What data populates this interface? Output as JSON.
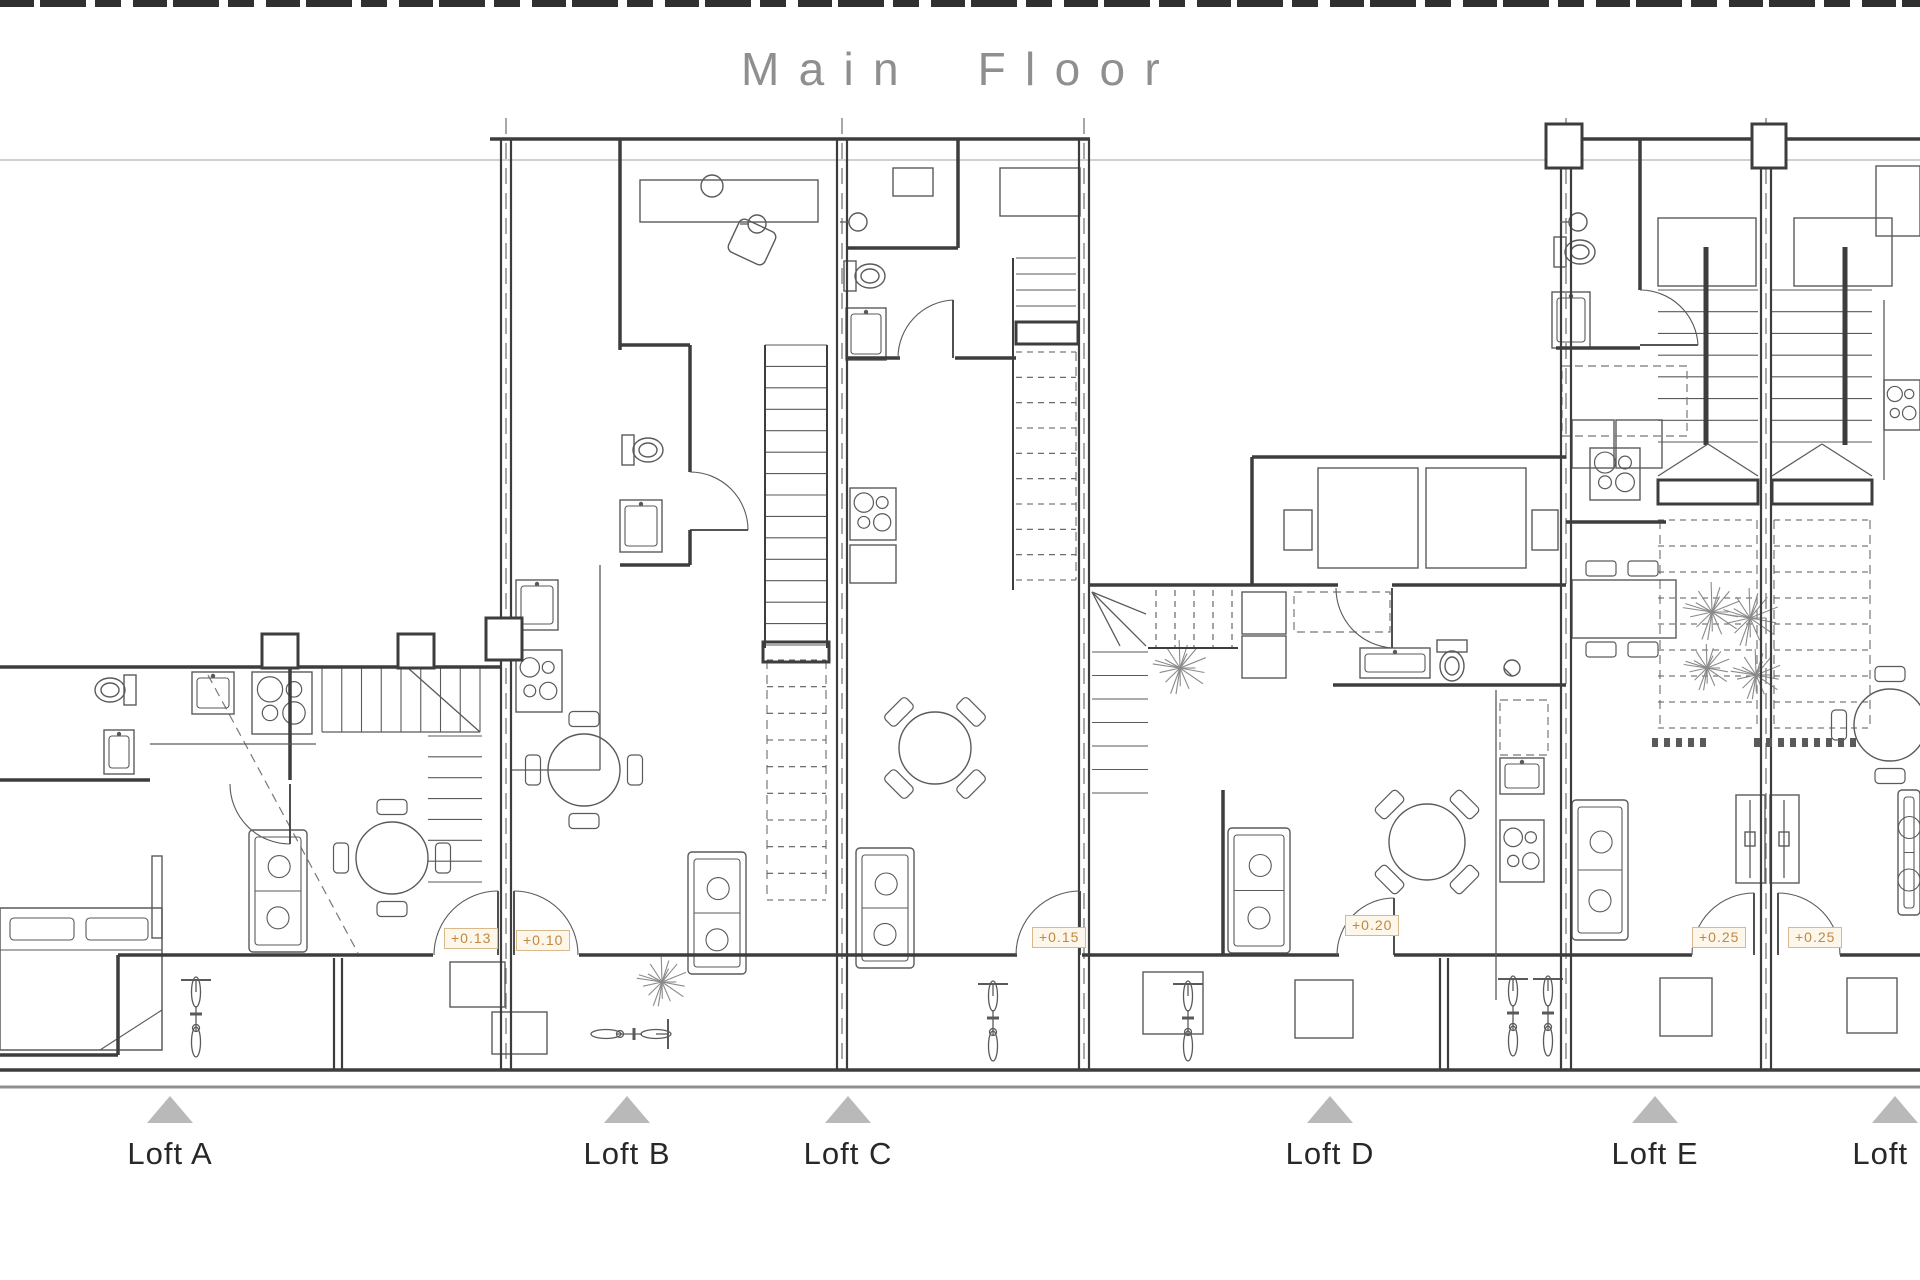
{
  "title": "Main Floor",
  "colors": {
    "wall": "#3d3d3d",
    "furniture": "#5a5a5a",
    "dashed": "#787878",
    "light": "#b5b5b5",
    "ground": "#8f8f8f",
    "plant": "#8a8a8a",
    "triangle": "#b9b9b9",
    "marker_text": "#c08840",
    "marker_border": "#d8b98c",
    "marker_bg": "#fdf6ea",
    "title": "#8f8f8f",
    "label": "#282828"
  },
  "elevation_markers": [
    {
      "label": "+0.13",
      "x": 444,
      "y": 928
    },
    {
      "label": "+0.10",
      "x": 516,
      "y": 930
    },
    {
      "label": "+0.15",
      "x": 1032,
      "y": 927
    },
    {
      "label": "+0.20",
      "x": 1345,
      "y": 915
    },
    {
      "label": "+0.25",
      "x": 1692,
      "y": 927
    },
    {
      "label": "+0.25",
      "x": 1788,
      "y": 927
    }
  ],
  "lofts": [
    {
      "label": "Loft A",
      "x": 170
    },
    {
      "label": "Loft B",
      "x": 627
    },
    {
      "label": "Loft C",
      "x": 848
    },
    {
      "label": "Loft D",
      "x": 1330
    },
    {
      "label": "Loft E",
      "x": 1655
    },
    {
      "label": "Loft F",
      "x": 1895
    }
  ],
  "plan": {
    "ref_line": [
      0,
      160,
      1920,
      160
    ],
    "ground_line": [
      0,
      1087,
      1920,
      1087
    ],
    "walls": [
      [
        490,
        139,
        1090,
        139
      ],
      [
        1548,
        139,
        1920,
        139
      ],
      [
        0,
        667,
        500,
        667
      ],
      [
        1090,
        585,
        1338,
        585
      ],
      [
        1392,
        585,
        1566,
        585
      ],
      [
        1252,
        457,
        1566,
        457
      ],
      [
        1252,
        457,
        1252,
        585
      ],
      [
        118,
        955,
        433,
        955
      ],
      [
        579,
        955,
        1017,
        955
      ],
      [
        1082,
        955,
        1339,
        955
      ],
      [
        1394,
        955,
        1692,
        955
      ],
      [
        1840,
        955,
        1920,
        955
      ],
      [
        0,
        1055,
        118,
        1055
      ],
      [
        118,
        955,
        118,
        1055
      ],
      [
        290,
        667,
        290,
        780
      ],
      [
        0,
        780,
        150,
        780
      ],
      [
        620,
        139,
        620,
        350
      ],
      [
        620,
        345,
        690,
        345
      ],
      [
        690,
        345,
        690,
        472
      ],
      [
        690,
        530,
        690,
        565
      ],
      [
        620,
        565,
        690,
        565
      ],
      [
        958,
        139,
        958,
        248
      ],
      [
        848,
        248,
        958,
        248
      ],
      [
        848,
        358,
        900,
        358
      ],
      [
        955,
        358,
        1016,
        358
      ],
      [
        1333,
        685,
        1566,
        685
      ],
      [
        1223,
        790,
        1223,
        955
      ],
      [
        1640,
        139,
        1640,
        290
      ],
      [
        1556,
        348,
        1640,
        348
      ],
      [
        1566,
        522,
        1666,
        522
      ],
      [
        0,
        1070,
        1920,
        1070
      ]
    ],
    "walls2": [
      [
        501,
        139,
        501,
        1070
      ],
      [
        511,
        139,
        511,
        1070
      ],
      [
        837,
        139,
        837,
        1070
      ],
      [
        847,
        139,
        847,
        1070
      ],
      [
        1079,
        139,
        1079,
        1070
      ],
      [
        1089,
        139,
        1089,
        1070
      ],
      [
        1561,
        139,
        1561,
        1070
      ],
      [
        1571,
        139,
        1571,
        1070
      ],
      [
        1761,
        139,
        1761,
        1070
      ],
      [
        1771,
        139,
        1771,
        1070
      ],
      [
        334,
        958,
        334,
        1070
      ],
      [
        342,
        958,
        342,
        1070
      ],
      [
        1440,
        958,
        1440,
        1070
      ],
      [
        1448,
        958,
        1448,
        1070
      ]
    ],
    "rails": [
      [
        765,
        345,
        765,
        648
      ],
      [
        827,
        345,
        827,
        648
      ],
      [
        1013,
        258,
        1013,
        590
      ],
      [
        1148,
        648,
        1238,
        648
      ]
    ],
    "bold": [
      [
        1706,
        247,
        1706,
        445
      ],
      [
        1845,
        247,
        1845,
        445
      ]
    ],
    "thin": [
      [
        150,
        744,
        316,
        744
      ],
      [
        600,
        565,
        600,
        770
      ],
      [
        512,
        770,
        600,
        770
      ],
      [
        1496,
        690,
        1496,
        1000
      ],
      [
        1884,
        300,
        1884,
        480
      ],
      [
        1750,
        800,
        1750,
        878
      ],
      [
        1784,
        800,
        1784,
        878
      ],
      [
        322,
        732,
        480,
        732
      ],
      [
        1658,
        476,
        1708,
        444
      ],
      [
        1708,
        444,
        1758,
        476
      ],
      [
        1772,
        476,
        1822,
        444
      ],
      [
        1822,
        444,
        1872,
        476
      ],
      [
        408,
        668,
        480,
        732
      ],
      [
        1092,
        592,
        1146,
        646
      ],
      [
        1092,
        592,
        1146,
        614
      ],
      [
        1092,
        592,
        1120,
        646
      ],
      [
        740,
        224,
        749,
        224
      ],
      [
        840,
        222,
        849,
        222
      ],
      [
        1560,
        222,
        1569,
        222
      ],
      [
        1504,
        668,
        1512,
        676
      ]
    ],
    "dash_heavy": [
      [
        506,
        118,
        506,
        1070
      ],
      [
        842,
        118,
        842,
        1070
      ],
      [
        1084,
        118,
        1084,
        1070
      ],
      [
        1566,
        118,
        1566,
        1070
      ],
      [
        1766,
        118,
        1766,
        1070
      ]
    ],
    "dash": [
      [
        208,
        675,
        358,
        953
      ],
      [
        767,
        660,
        767,
        900
      ],
      [
        826,
        660,
        826,
        900
      ],
      [
        1076,
        352,
        1076,
        580
      ],
      [
        1660,
        520,
        1660,
        728
      ],
      [
        1757,
        520,
        1757,
        728
      ],
      [
        1774,
        520,
        1774,
        728
      ],
      [
        1870,
        520,
        1870,
        728
      ]
    ],
    "treads": [
      [
        322,
        668,
        158,
        64,
        8,
        0,
        0
      ],
      [
        428,
        736,
        54,
        146,
        7,
        1,
        0
      ],
      [
        765,
        345,
        62,
        300,
        14,
        1,
        0
      ],
      [
        767,
        660,
        59,
        240,
        9,
        1,
        1
      ],
      [
        1016,
        258,
        60,
        64,
        4,
        1,
        0
      ],
      [
        1016,
        352,
        60,
        228,
        9,
        1,
        1
      ],
      [
        1156,
        590,
        76,
        58,
        4,
        0,
        1
      ],
      [
        1092,
        652,
        56,
        141,
        6,
        1,
        0
      ],
      [
        1658,
        290,
        100,
        152,
        7,
        1,
        0
      ],
      [
        1658,
        520,
        99,
        208,
        8,
        1,
        1
      ],
      [
        1772,
        290,
        100,
        152,
        7,
        1,
        0
      ],
      [
        1774,
        520,
        96,
        208,
        8,
        1,
        1
      ]
    ],
    "rects": [
      [
        152,
        856,
        10,
        82
      ],
      [
        450,
        962,
        55,
        45
      ],
      [
        492,
        1012,
        55,
        42
      ],
      [
        640,
        180,
        178,
        42
      ],
      [
        893,
        168,
        40,
        28
      ],
      [
        1000,
        168,
        80,
        48
      ],
      [
        850,
        545,
        46,
        38
      ],
      [
        1295,
        980,
        58,
        58
      ],
      [
        1143,
        972,
        60,
        62
      ],
      [
        1284,
        510,
        28,
        40
      ],
      [
        1532,
        510,
        26,
        40
      ],
      [
        1318,
        468,
        100,
        100
      ],
      [
        1426,
        468,
        100,
        100
      ],
      [
        1658,
        218,
        98,
        68
      ],
      [
        1794,
        218,
        98,
        68
      ],
      [
        1572,
        420,
        42,
        48
      ],
      [
        1616,
        420,
        46,
        48
      ],
      [
        1660,
        978,
        52,
        58
      ],
      [
        1736,
        795,
        29,
        88
      ],
      [
        1770,
        795,
        29,
        88
      ],
      [
        1745,
        832,
        10,
        14
      ],
      [
        1779,
        832,
        10,
        14
      ],
      [
        1876,
        166,
        44,
        70
      ],
      [
        1847,
        978,
        50,
        55
      ],
      [
        1242,
        592,
        44,
        42
      ],
      [
        1242,
        636,
        44,
        42
      ]
    ],
    "bold_rects": [
      [
        763,
        642,
        66,
        20
      ],
      [
        1016,
        322,
        62,
        22
      ],
      [
        1658,
        480,
        100,
        24
      ],
      [
        1772,
        480,
        100,
        24
      ]
    ],
    "dash_rects": [
      [
        1294,
        592,
        96,
        40
      ],
      [
        1500,
        700,
        48,
        55
      ],
      [
        1562,
        366,
        125,
        70
      ]
    ],
    "doors": [
      [
        290,
        784,
        290,
        844,
        230,
        784,
        1
      ],
      [
        690,
        530,
        748,
        530,
        690,
        472,
        0
      ],
      [
        953,
        358,
        953,
        300,
        898,
        358,
        0
      ],
      [
        1392,
        588,
        1392,
        648,
        1336,
        588,
        1
      ],
      [
        1640,
        345,
        1698,
        345,
        1640,
        290,
        0
      ],
      [
        498,
        955,
        498,
        891,
        434,
        955,
        0
      ],
      [
        514,
        955,
        514,
        891,
        578,
        955,
        1
      ],
      [
        1080,
        955,
        1080,
        891,
        1016,
        955,
        0
      ],
      [
        1394,
        955,
        1394,
        898,
        1337,
        955,
        0
      ],
      [
        1754,
        955,
        1754,
        893,
        1692,
        955,
        0
      ],
      [
        1778,
        955,
        1778,
        893,
        1840,
        955,
        1
      ]
    ],
    "circles": [
      [
        757,
        224,
        9
      ],
      [
        858,
        222,
        9
      ],
      [
        1578,
        222,
        9
      ],
      [
        1512,
        668,
        8
      ],
      [
        712,
        186,
        11
      ]
    ],
    "toilets": [
      [
        132,
        690,
        180
      ],
      [
        626,
        450,
        0
      ],
      [
        848,
        276,
        0
      ],
      [
        1452,
        644,
        90
      ],
      [
        1558,
        252,
        0
      ]
    ],
    "sinks": [
      [
        104,
        730,
        30,
        44
      ],
      [
        192,
        672,
        42,
        42
      ],
      [
        620,
        500,
        42,
        52
      ],
      [
        516,
        580,
        42,
        50
      ],
      [
        846,
        308,
        40,
        52
      ],
      [
        1500,
        758,
        44,
        36
      ],
      [
        1552,
        292,
        38,
        56
      ],
      [
        1360,
        648,
        70,
        30
      ]
    ],
    "stoves": [
      [
        252,
        672,
        60,
        62
      ],
      [
        516,
        650,
        46,
        62
      ],
      [
        850,
        488,
        46,
        52
      ],
      [
        1500,
        820,
        44,
        62
      ],
      [
        1590,
        448,
        50,
        52
      ],
      [
        1884,
        380,
        36,
        50
      ]
    ],
    "tables_round": [
      [
        392,
        858,
        36,
        0
      ],
      [
        584,
        770,
        36,
        0
      ],
      [
        935,
        748,
        36,
        45
      ],
      [
        1427,
        842,
        38,
        45
      ],
      [
        1890,
        725,
        36,
        0
      ]
    ],
    "tables_rect": [
      [
        1572,
        580,
        104,
        58
      ]
    ],
    "sofas": [
      [
        249,
        830,
        58,
        122
      ],
      [
        688,
        852,
        58,
        122
      ],
      [
        856,
        848,
        58,
        120
      ],
      [
        1228,
        828,
        62,
        125
      ],
      [
        1572,
        800,
        56,
        140
      ],
      [
        1898,
        790,
        22,
        125
      ]
    ],
    "beds": [
      [
        0,
        908,
        162,
        142
      ]
    ],
    "plants": [
      [
        662,
        982,
        26
      ],
      [
        1180,
        668,
        28
      ],
      [
        1712,
        612,
        30
      ],
      [
        1707,
        668,
        24
      ],
      [
        1750,
        618,
        30
      ],
      [
        1756,
        675,
        26
      ]
    ],
    "bikes": [
      [
        196,
        1016,
        0
      ],
      [
        632,
        1034,
        90
      ],
      [
        993,
        1020,
        0
      ],
      [
        1188,
        1020,
        0
      ],
      [
        1513,
        1015,
        0
      ],
      [
        1548,
        1015,
        0
      ]
    ],
    "chairs_free": [
      [
        752,
        242,
        40,
        36,
        25
      ]
    ],
    "columns": [
      [
        262,
        634,
        36,
        34
      ],
      [
        398,
        634,
        36,
        34
      ],
      [
        486,
        618,
        36,
        42
      ],
      [
        1546,
        124,
        36,
        44
      ],
      [
        1752,
        124,
        34,
        44
      ]
    ],
    "dot_rows": [
      [
        1652,
        738,
        5,
        12,
        6
      ],
      [
        1754,
        738,
        9,
        12,
        6
      ]
    ]
  }
}
